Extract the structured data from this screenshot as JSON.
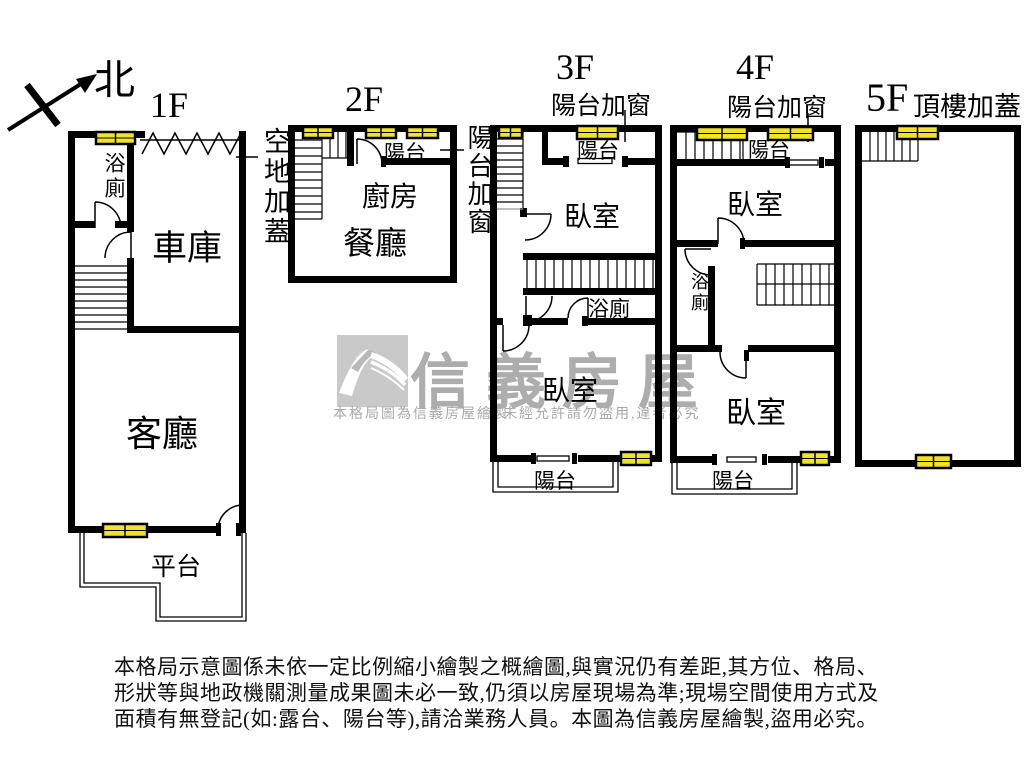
{
  "compass": {
    "north_label": "北"
  },
  "floors": {
    "f1": {
      "label": "1F",
      "side_note": "空地加蓋",
      "rooms": {
        "bath": "浴廁",
        "garage": "車庫",
        "living": "客廳",
        "platform": "平台"
      }
    },
    "f2": {
      "label": "2F",
      "side_note": "陽台加窗",
      "rooms": {
        "balcony": "陽台",
        "kitchen": "廚房",
        "dining": "餐廳"
      }
    },
    "f3": {
      "label": "3F",
      "subtitle": "陽台加窗",
      "rooms": {
        "balcony_top": "陽台",
        "bedroom_top": "臥室",
        "bath": "浴廁",
        "bedroom_bottom": "臥室",
        "balcony_bottom": "陽台"
      }
    },
    "f4": {
      "label": "4F",
      "subtitle": "陽台加窗",
      "rooms": {
        "balcony_top": "陽台",
        "bedroom_top": "臥室",
        "bath": "浴廁",
        "bedroom_bottom": "臥室",
        "balcony_bottom": "陽台"
      }
    },
    "f5": {
      "label": "5F",
      "subtitle": "頂樓加蓋"
    }
  },
  "watermark": {
    "brand": "信義房屋",
    "note_left": "本格局圖為信義房屋繪製",
    "note_right": "未經允許請勿盜用,違者必究"
  },
  "disclaimer": {
    "line1": "本格局示意圖係未依一定比例縮小繪製之概繪圖,與實況仍有差距,其方位、格局、",
    "line2": "形狀等與地政機關測量成果圖未必一致,仍須以房屋現場為準;現場空間使用方式及",
    "line3": "面積有無登記(如:露台、陽台等),請洽業務人員。本圖為信義房屋繪製,盜用必究。"
  },
  "colors": {
    "wall": "#000000",
    "window_fill": "#f2e32a",
    "watermark_gray": "#adadad"
  }
}
